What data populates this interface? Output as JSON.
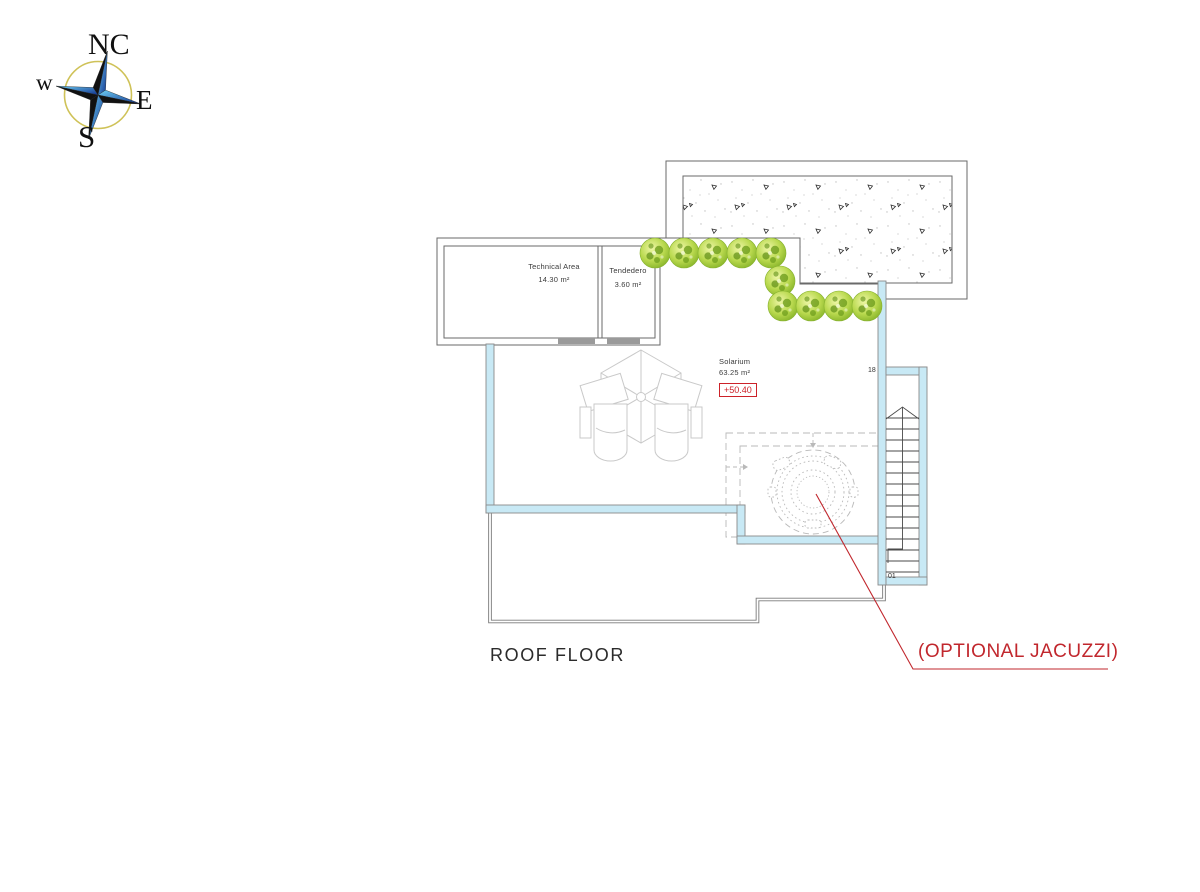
{
  "drawing": {
    "floor_label": "ROOF FLOOR",
    "annotation": "(OPTIONAL JACUZZI)",
    "elevation_marker": "+50.40"
  },
  "compass": {
    "north": "NC",
    "west": "w",
    "east": "E",
    "south": "S"
  },
  "rooms": [
    {
      "name": "Technical Area",
      "area": "14.30 m²"
    },
    {
      "name": "Tendedero",
      "area": "3.60 m²"
    },
    {
      "name": "Solarium",
      "area": "63.25 m²"
    }
  ],
  "stairs": {
    "top_label": "18",
    "bottom_label": "01"
  },
  "colors": {
    "annotation_red": "#c1272d",
    "elevation_red": "#cc2229",
    "parapet_cyan": "#c8e9f5",
    "bush_green": "#8fbe2a",
    "compass_blue": "#2a9fe0",
    "compass_ring_gold": "#cfc258",
    "line_gray": "#6a6a6a"
  }
}
